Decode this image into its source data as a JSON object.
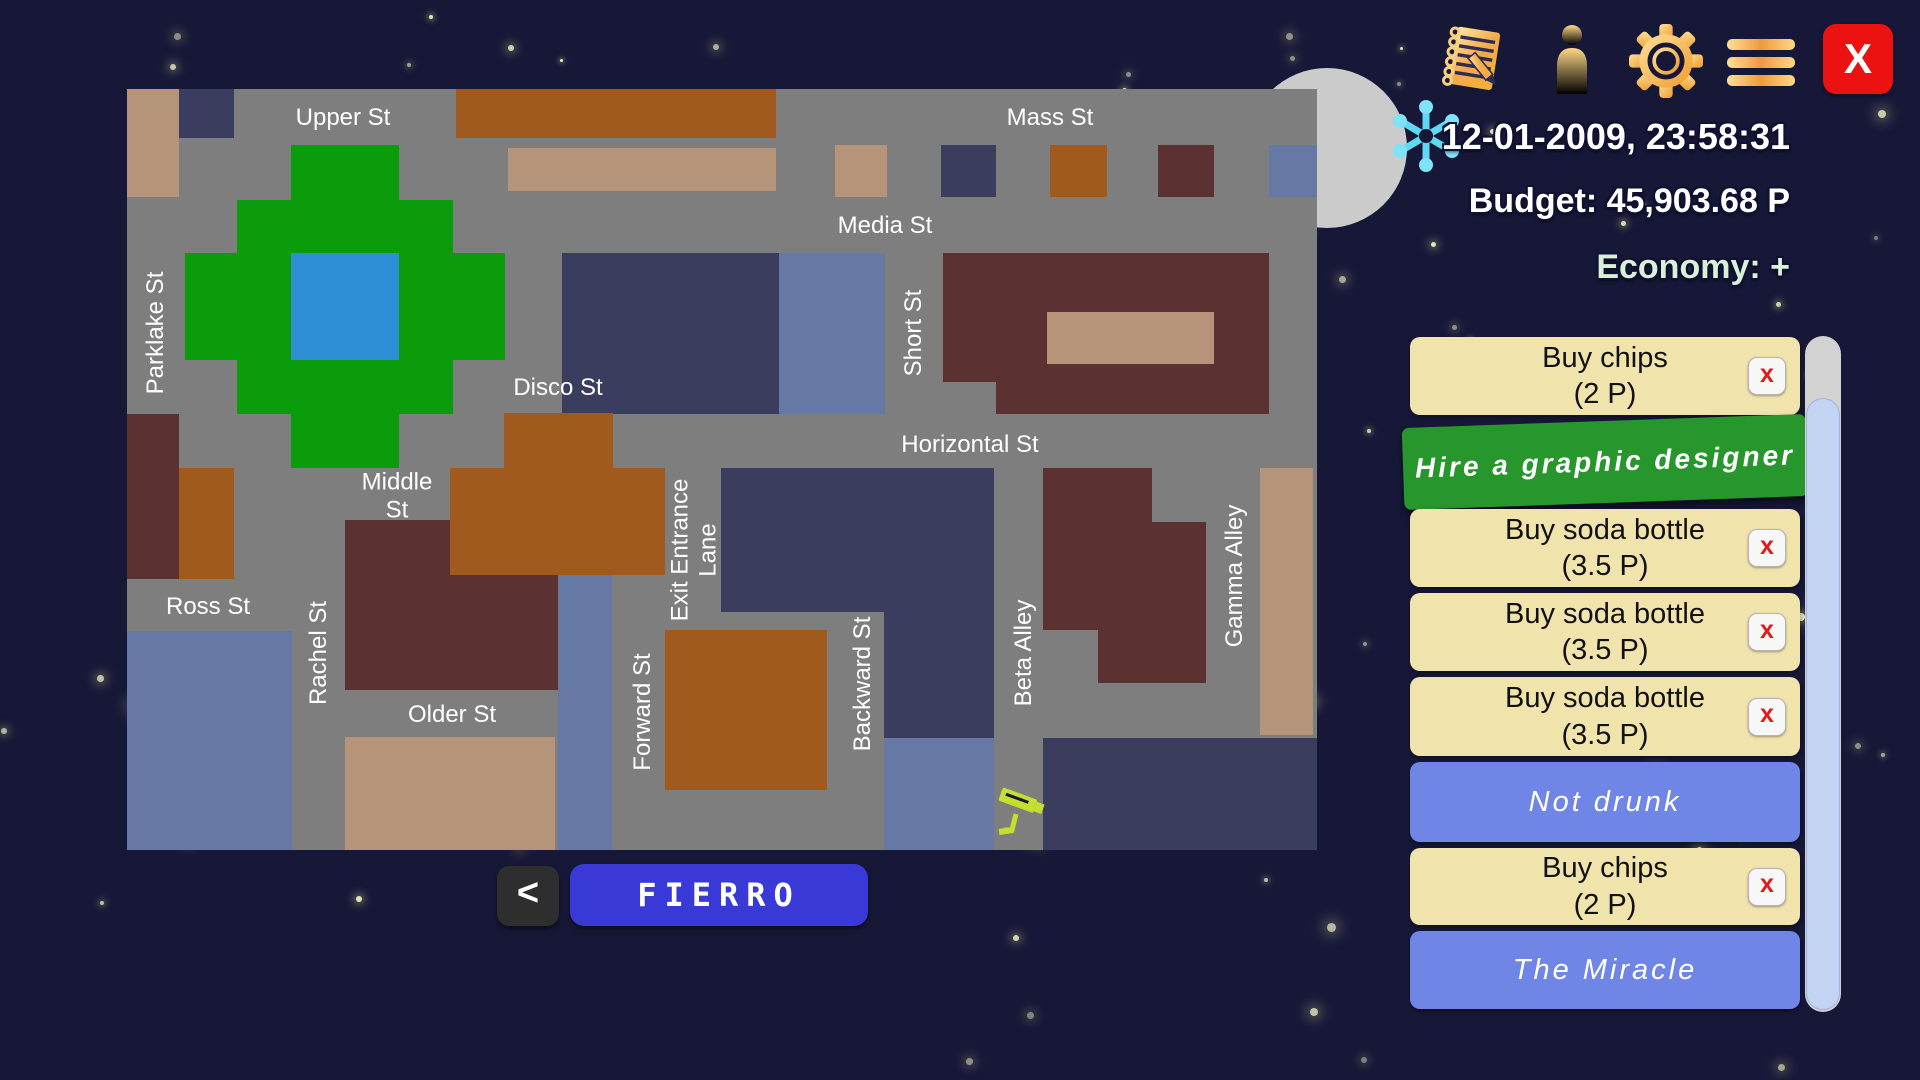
{
  "hud": {
    "datetime": "12-01-2009, 23:58:31",
    "budget": "Budget: 45,903.68 P",
    "economy": "Economy: +",
    "close_label": "X",
    "icons": [
      {
        "name": "notes-icon"
      },
      {
        "name": "person-icon"
      },
      {
        "name": "gear-icon"
      },
      {
        "name": "menu-icon"
      }
    ],
    "weather_icon": "snowflake-icon"
  },
  "map": {
    "city_name": "FIERRO",
    "back_label": "<",
    "streets": [
      {
        "label": "Upper St",
        "x": 216,
        "y": 29,
        "vertical": false
      },
      {
        "label": "Mass St",
        "x": 923,
        "y": 29,
        "vertical": false
      },
      {
        "label": "Media St",
        "x": 758,
        "y": 137,
        "vertical": false
      },
      {
        "label": "Parklake St",
        "x": 29,
        "y": 244,
        "vertical": true
      },
      {
        "label": "Short St",
        "x": 787,
        "y": 244,
        "vertical": true
      },
      {
        "label": "Disco St",
        "x": 431,
        "y": 299,
        "vertical": false
      },
      {
        "label": "Horizontal St",
        "x": 843,
        "y": 356,
        "vertical": false
      },
      {
        "label": "Middle St",
        "x": 270,
        "y": 408,
        "vertical": false,
        "lines": [
          "Middle",
          "St"
        ]
      },
      {
        "label": "Exit Entrance Lane",
        "x": 568,
        "y": 461,
        "vertical": true,
        "lines": [
          "Exit Entrance",
          "Lane"
        ]
      },
      {
        "label": "Ross St",
        "x": 81,
        "y": 518,
        "vertical": false
      },
      {
        "label": "Rachel St",
        "x": 192,
        "y": 564,
        "vertical": true
      },
      {
        "label": "Older St",
        "x": 325,
        "y": 626,
        "vertical": false
      },
      {
        "label": "Forward St",
        "x": 516,
        "y": 623,
        "vertical": true
      },
      {
        "label": "Backward St",
        "x": 736,
        "y": 595,
        "vertical": true
      },
      {
        "label": "Beta Alley",
        "x": 897,
        "y": 564,
        "vertical": true
      },
      {
        "label": "Gamma Alley",
        "x": 1108,
        "y": 487,
        "vertical": true
      }
    ],
    "buildings": [
      {
        "x": 0,
        "y": 0,
        "w": 52,
        "h": 108,
        "c": "tan"
      },
      {
        "x": 52,
        "y": 0,
        "w": 55,
        "h": 49,
        "c": "navy"
      },
      {
        "x": 329,
        "y": 0,
        "w": 320,
        "h": 49,
        "c": "brown"
      },
      {
        "x": 381,
        "y": 59,
        "w": 268,
        "h": 43,
        "c": "tan"
      },
      {
        "x": 708,
        "y": 56,
        "w": 52,
        "h": 52,
        "c": "tan"
      },
      {
        "x": 814,
        "y": 56,
        "w": 55,
        "h": 52,
        "c": "navy"
      },
      {
        "x": 923,
        "y": 56,
        "w": 57,
        "h": 52,
        "c": "brown"
      },
      {
        "x": 1031,
        "y": 56,
        "w": 56,
        "h": 52,
        "c": "maroon"
      },
      {
        "x": 1142,
        "y": 56,
        "w": 48,
        "h": 52,
        "c": "steel"
      },
      {
        "x": 164,
        "y": 56,
        "w": 108,
        "h": 323,
        "c": "green"
      },
      {
        "x": 110,
        "y": 111,
        "w": 216,
        "h": 214,
        "c": "green"
      },
      {
        "x": 58,
        "y": 164,
        "w": 320,
        "h": 107,
        "c": "green"
      },
      {
        "x": 164,
        "y": 164,
        "w": 108,
        "h": 107,
        "c": "lake"
      },
      {
        "x": 435,
        "y": 164,
        "w": 217,
        "h": 161,
        "c": "navy"
      },
      {
        "x": 652,
        "y": 164,
        "w": 106,
        "h": 161,
        "c": "steel"
      },
      {
        "x": 816,
        "y": 164,
        "w": 326,
        "h": 129,
        "c": "maroon"
      },
      {
        "x": 920,
        "y": 223,
        "w": 167,
        "h": 52,
        "c": "tan"
      },
      {
        "x": 869,
        "y": 293,
        "w": 273,
        "h": 32,
        "c": "maroon"
      },
      {
        "x": 0,
        "y": 325,
        "w": 52,
        "h": 165,
        "c": "maroon"
      },
      {
        "x": 52,
        "y": 379,
        "w": 55,
        "h": 111,
        "c": "brown"
      },
      {
        "x": 218,
        "y": 431,
        "w": 213,
        "h": 170,
        "c": "maroon"
      },
      {
        "x": 377,
        "y": 324,
        "w": 109,
        "h": 55,
        "c": "brown"
      },
      {
        "x": 323,
        "y": 379,
        "w": 215,
        "h": 107,
        "c": "brown"
      },
      {
        "x": 431,
        "y": 486,
        "w": 54,
        "h": 275,
        "c": "steel"
      },
      {
        "x": 218,
        "y": 648,
        "w": 210,
        "h": 113,
        "c": "tan"
      },
      {
        "x": 0,
        "y": 542,
        "w": 165,
        "h": 219,
        "c": "steel"
      },
      {
        "x": 594,
        "y": 379,
        "w": 273,
        "h": 144,
        "c": "navy"
      },
      {
        "x": 757,
        "y": 523,
        "w": 110,
        "h": 126,
        "c": "navy"
      },
      {
        "x": 538,
        "y": 541,
        "w": 162,
        "h": 160,
        "c": "brown"
      },
      {
        "x": 757,
        "y": 649,
        "w": 110,
        "h": 112,
        "c": "steel"
      },
      {
        "x": 916,
        "y": 379,
        "w": 109,
        "h": 162,
        "c": "maroon"
      },
      {
        "x": 1025,
        "y": 433,
        "w": 54,
        "h": 161,
        "c": "maroon"
      },
      {
        "x": 971,
        "y": 541,
        "w": 108,
        "h": 53,
        "c": "maroon"
      },
      {
        "x": 1133,
        "y": 379,
        "w": 53,
        "h": 267,
        "c": "tan"
      },
      {
        "x": 916,
        "y": 649,
        "w": 274,
        "h": 112,
        "c": "navy"
      }
    ],
    "camera": {
      "name": "security-camera-icon",
      "x": 869,
      "y": 695
    }
  },
  "sidebar": {
    "delete_label": "x",
    "items": [
      {
        "type": "order",
        "label": "Buy chips",
        "price": "(2 P)"
      },
      {
        "type": "action",
        "label": "Hire a graphic designer"
      },
      {
        "type": "order",
        "label": "Buy soda bottle",
        "price": "(3.5 P)"
      },
      {
        "type": "order",
        "label": "Buy soda bottle",
        "price": "(3.5 P)"
      },
      {
        "type": "order",
        "label": "Buy soda bottle",
        "price": "(3.5 P)"
      },
      {
        "type": "status",
        "label": "Not drunk"
      },
      {
        "type": "order",
        "label": "Buy chips",
        "price": "(2 P)"
      },
      {
        "type": "status",
        "label": "The Miracle"
      }
    ]
  },
  "colors": {
    "sky": "#171838",
    "street_gray": "#7e7e7e",
    "palette": {
      "tan": "#b5947a",
      "navy": "#3a3d5e",
      "steel": "#6679a4",
      "brown": "#a05a1d",
      "maroon": "#5b3132",
      "green": "#0a9c0a",
      "lake": "#2e8ed6"
    },
    "moon": "#cbcbcb",
    "order_cream": "#f0e3ac",
    "action_green": "#27962c",
    "status_blue": "#6f86e7",
    "fierro_blue": "#3939d8",
    "close_red": "#ec1212",
    "icon_gold": "#f5b547",
    "snowflake_cyan": "#5fd9f3",
    "camera_yellow": "#c6df2e",
    "economy_green": "#d9f0d9"
  }
}
